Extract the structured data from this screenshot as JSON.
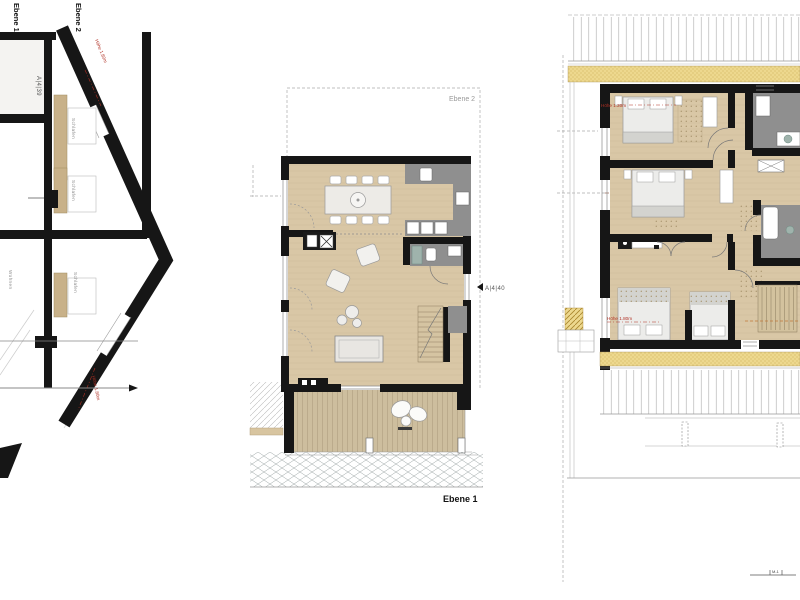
{
  "section": {
    "level_labels": [
      "Ebene 1",
      "Ebene 2"
    ],
    "marker": "A|4|39",
    "height_top": "Höhe 1.80m",
    "height_bottom": "Höhe 1.80m",
    "rooms": [
      "Schlafen",
      "Schlafen",
      "Schlafen",
      "Wohnen"
    ]
  },
  "plan_level1": {
    "overlay_label": "Ebene 2",
    "marker": "A|4|40",
    "caption": "Ebene 1"
  },
  "plan_level2": {
    "height_label_front": "Höhe 1.20m",
    "height_label_back": "Höhe 1.80m",
    "scale_mark": "M-1"
  },
  "colors": {
    "wood_floor": "#d9c7a6",
    "deck": "#cdbe9e",
    "wet_room_gray": "#8f8f8f",
    "wall_black": "#161616",
    "insulation_yellow": "#edd88e",
    "annotation_red": "#b03024"
  }
}
